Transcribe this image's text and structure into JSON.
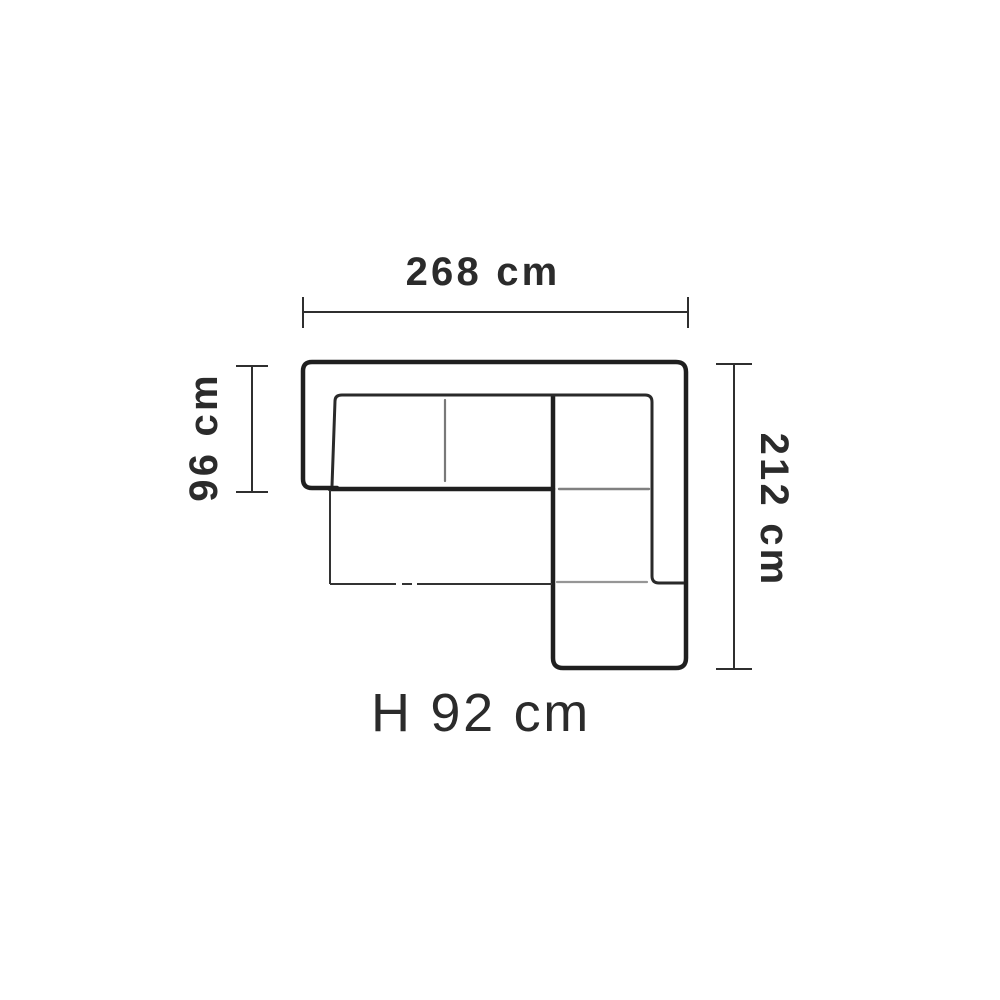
{
  "diagram": {
    "labels": {
      "width": "268 cm",
      "depth": "96 cm",
      "length": "212 cm",
      "height": "H 92 cm"
    },
    "dimensions_cm": {
      "width": 268,
      "depth": 96,
      "length": 212,
      "height": 92
    },
    "colors": {
      "background": "#ffffff",
      "outline": "#1f1f1f",
      "inner_line": "#2a2a2a",
      "thin_line": "#333333",
      "divider": "#6a6a6a",
      "dimension_line": "#2f2f2f",
      "text": "#2b2b2b"
    }
  }
}
